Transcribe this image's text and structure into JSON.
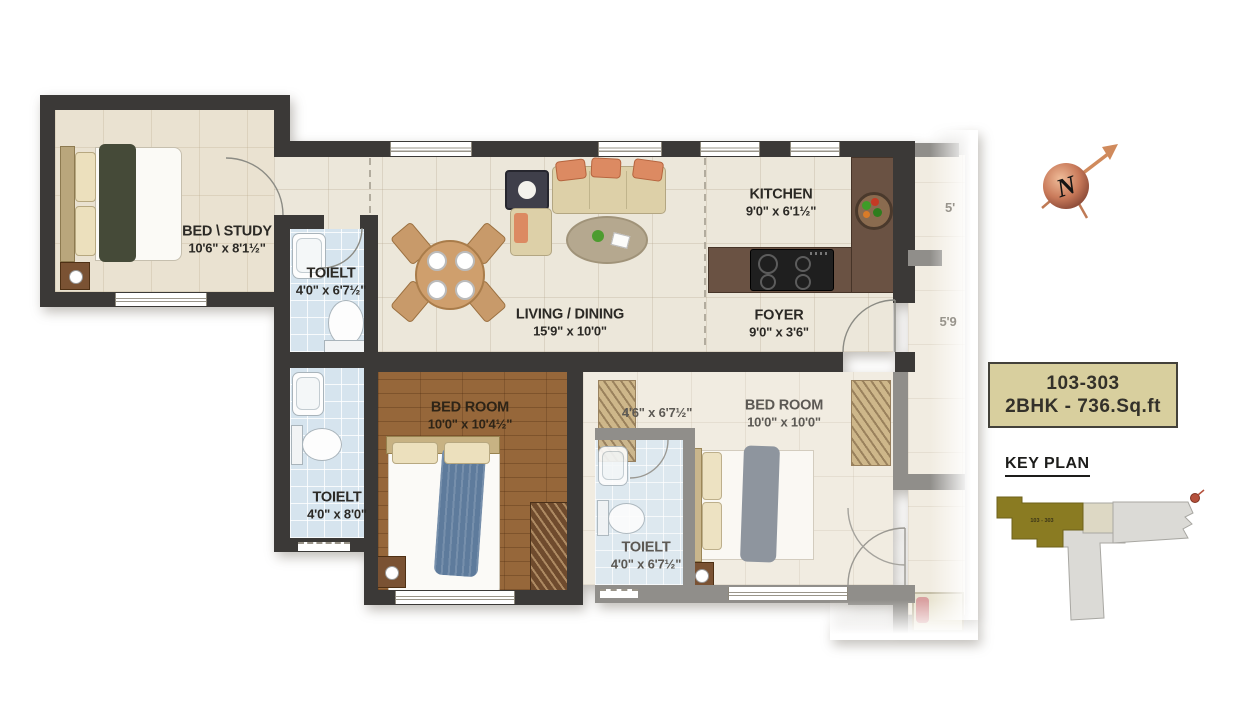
{
  "plan": {
    "rooms": {
      "bed_study": {
        "name": "BED \\ STUDY",
        "dims": "10'6\" x 8'1½\""
      },
      "toilet_top": {
        "name": "TOIELT",
        "dims": "4'0\" x 6'7½\""
      },
      "living_dining": {
        "name": "LIVING / DINING",
        "dims": "15'9\" x 10'0\""
      },
      "kitchen": {
        "name": "KITCHEN",
        "dims": "9'0\" x 6'1½\""
      },
      "foyer": {
        "name": "FOYER",
        "dims": "9'0\" x 3'6\""
      },
      "bedroom_master": {
        "name": "BED ROOM",
        "dims": "10'0\" x 10'4½\""
      },
      "toilet_master": {
        "name": "TOIELT",
        "dims": "4'0\" x 8'0\""
      },
      "passage": {
        "dims": "4'6\" x 6'7½\""
      },
      "bedroom_second": {
        "name": "BED ROOM",
        "dims": "10'0\" x 10'0\""
      },
      "toilet_second": {
        "name": "TOIELT",
        "dims": "4'0\" x 6'7½\""
      },
      "adjacent_dim_top": "5'",
      "adjacent_dim_mid": "5'9"
    }
  },
  "compass": {
    "letter": "N"
  },
  "unit_badge": {
    "line1": "103-303",
    "line2": "2BHK - 736.Sq.ft"
  },
  "key_plan": {
    "title": "KEY PLAN",
    "highlight_label": "103 - 303"
  },
  "colors": {
    "wall_dark": "#3b3937",
    "wall_faded": "#908e8a",
    "floor_beige": "#ece7da",
    "floor_toilet": "#d6e4ee",
    "floor_wood": "#96673a",
    "counter_brown": "#6a5243",
    "accent_salmon": "#dc8a62",
    "badge_bg": "#d8cf9e",
    "keyplan_highlight": "#8a7b22"
  }
}
